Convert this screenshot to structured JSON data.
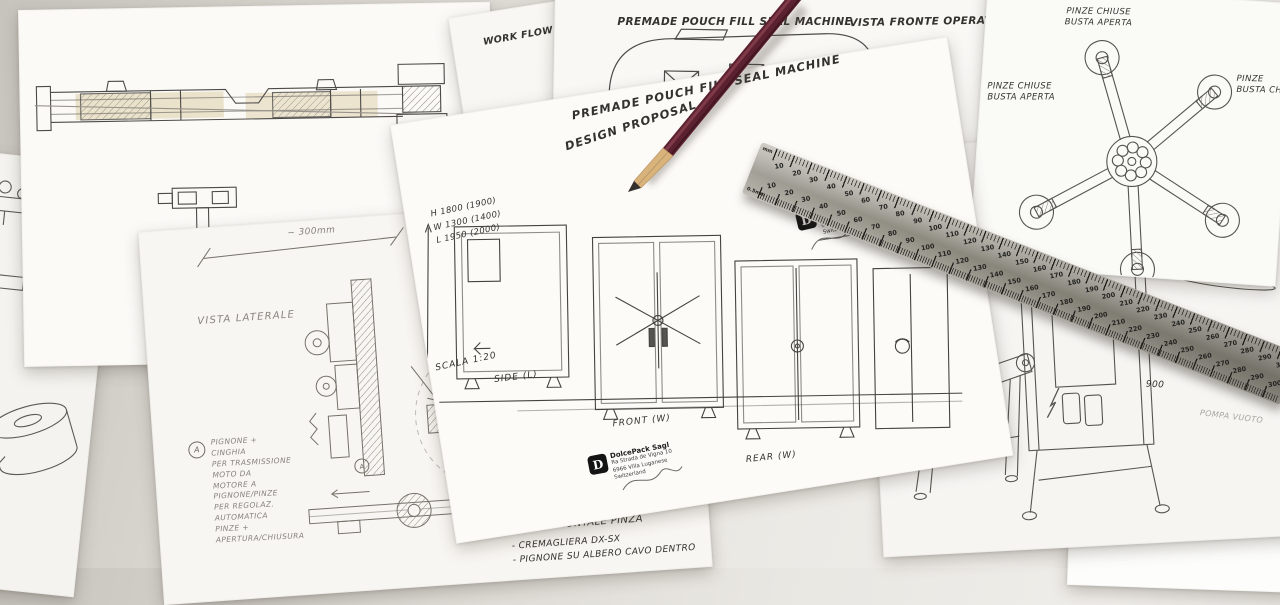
{
  "sheet_top_center": {
    "title": "PREMADE POUCH FILL SEAL MACHINE",
    "view_label": "VISTA FRONTE OPERATORE",
    "circled_number": "6",
    "logo_partial": "ck Sagl\nda Vigna 10\na Luganese\nand"
  },
  "sheet_workflow": {
    "label": "WORK FLOW PROPOSAL"
  },
  "sheet_center": {
    "title": "PREMADE POUCH FILL SEAL MACHINE",
    "subtitle": "DESIGN PROPOSAL",
    "dimensions": "H 1800 (1900)\nW 1300 (1400)\nL 1950 (2000)",
    "scale": "SCALA 1:20",
    "label_side": "SIDE (L)",
    "label_front": "FRONT (W)",
    "label_rear": "REAR (W)",
    "logo": {
      "mark": "D",
      "company": "DolcePack Sagl",
      "address": "Ra Strada de Vigna 10\n6966 Villa Luganese\nSwitzerland"
    }
  },
  "sheet_top_right": {
    "label_top": "PINZE CHIUSE\nBUSTA APERTA",
    "label_left": "PINZE CHIUSE\nBUSTA APERTA",
    "label_right": "PINZE\nBUSTA CHI"
  },
  "sheet_bottom_left": {
    "view_label": "VISTA LATERALE",
    "dim_label": "~ 300mm",
    "note_marker": "A",
    "notes": "PIGNONE +\nCINGHIA\nPER TRASMISSIONE\nMOTO DA\nMOTORE A\nPIGNONE/PINZE\nPER REGOLAZ.\nAUTOMATICA\nPINZE +\nAPERTURA/CHIUSURA",
    "front_title": "VISTA FRONTALE PINZA",
    "front_notes": "- CREMAGLIERA DX-SX\n- PIGNONE SU ALBERO CAVO DENTRO"
  },
  "sheet_right": {
    "dim_height": "1700",
    "dim_width": "900",
    "note": "POMPA VUOTO"
  },
  "sheet_bottom_right": {
    "initials": "A.F"
  },
  "ruler": {
    "top_unit": "mm",
    "bottom_unit": "0.5mm",
    "numbers": [
      10,
      20,
      30,
      40,
      50,
      60,
      70,
      80,
      90,
      100,
      110,
      120,
      130,
      140,
      150,
      160,
      170,
      180,
      190,
      200,
      210,
      220,
      230,
      240,
      250,
      260,
      270,
      280,
      290,
      300
    ]
  }
}
